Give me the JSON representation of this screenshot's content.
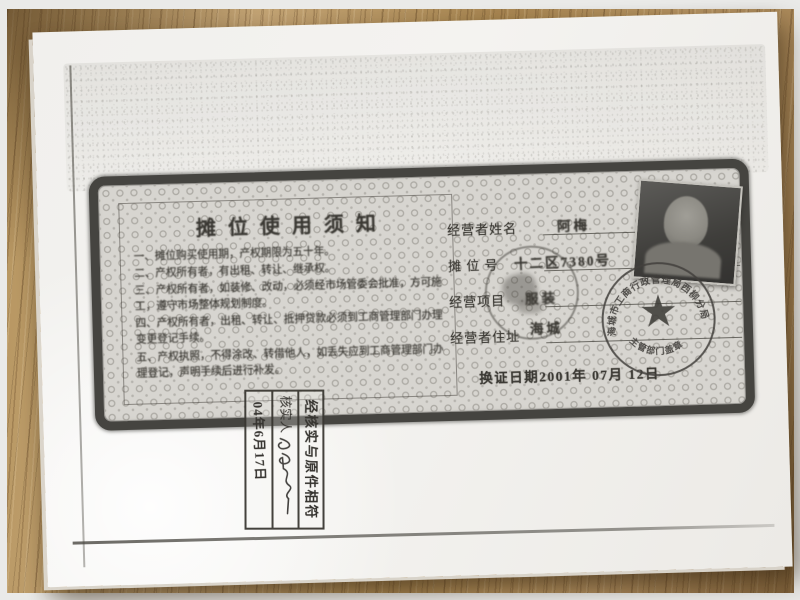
{
  "colors": {
    "paper": "#f3f2ef",
    "wood": "#ab8756",
    "certificate_ink": "#3a3833",
    "stamp_ink": "#45433f"
  },
  "certificate": {
    "notice": {
      "title": "摊位使用须知",
      "items": [
        "一、摊位购买使用期，产权期限为五十年。",
        "二、产权所有者，有出租、转让、继承权。",
        "三、产权所有者，如装修、改动，必须经市场管委会批准，方可施工，遵守市场整体规划制度。",
        "四、产权所有者，出租、转让、抵押贷款必须到工商管理部门办理变更登记手续。",
        "五、产权执照，不得涂改、转借他人，如丢失应到工商管理部门办理登记，声明手续后进行补发。"
      ]
    },
    "fields": [
      {
        "label": "经营者姓名",
        "value": "阿梅"
      },
      {
        "label": "摊 位 号",
        "value": "十二区7380号"
      },
      {
        "label": "经营项目",
        "value": "服装"
      },
      {
        "label": "经营者住址",
        "value": "海城"
      }
    ],
    "renewal_date": "换证日期2001年 07月 12日",
    "official_stamp": {
      "arc_top": "海城市工商行政管理局西柳分局",
      "arc_bottom": "主管部门盖章",
      "star": "★"
    }
  },
  "verification_stamp": {
    "line1": "经核实与原件相符",
    "verifier_label": "核实人",
    "date": "04年6月17日"
  }
}
